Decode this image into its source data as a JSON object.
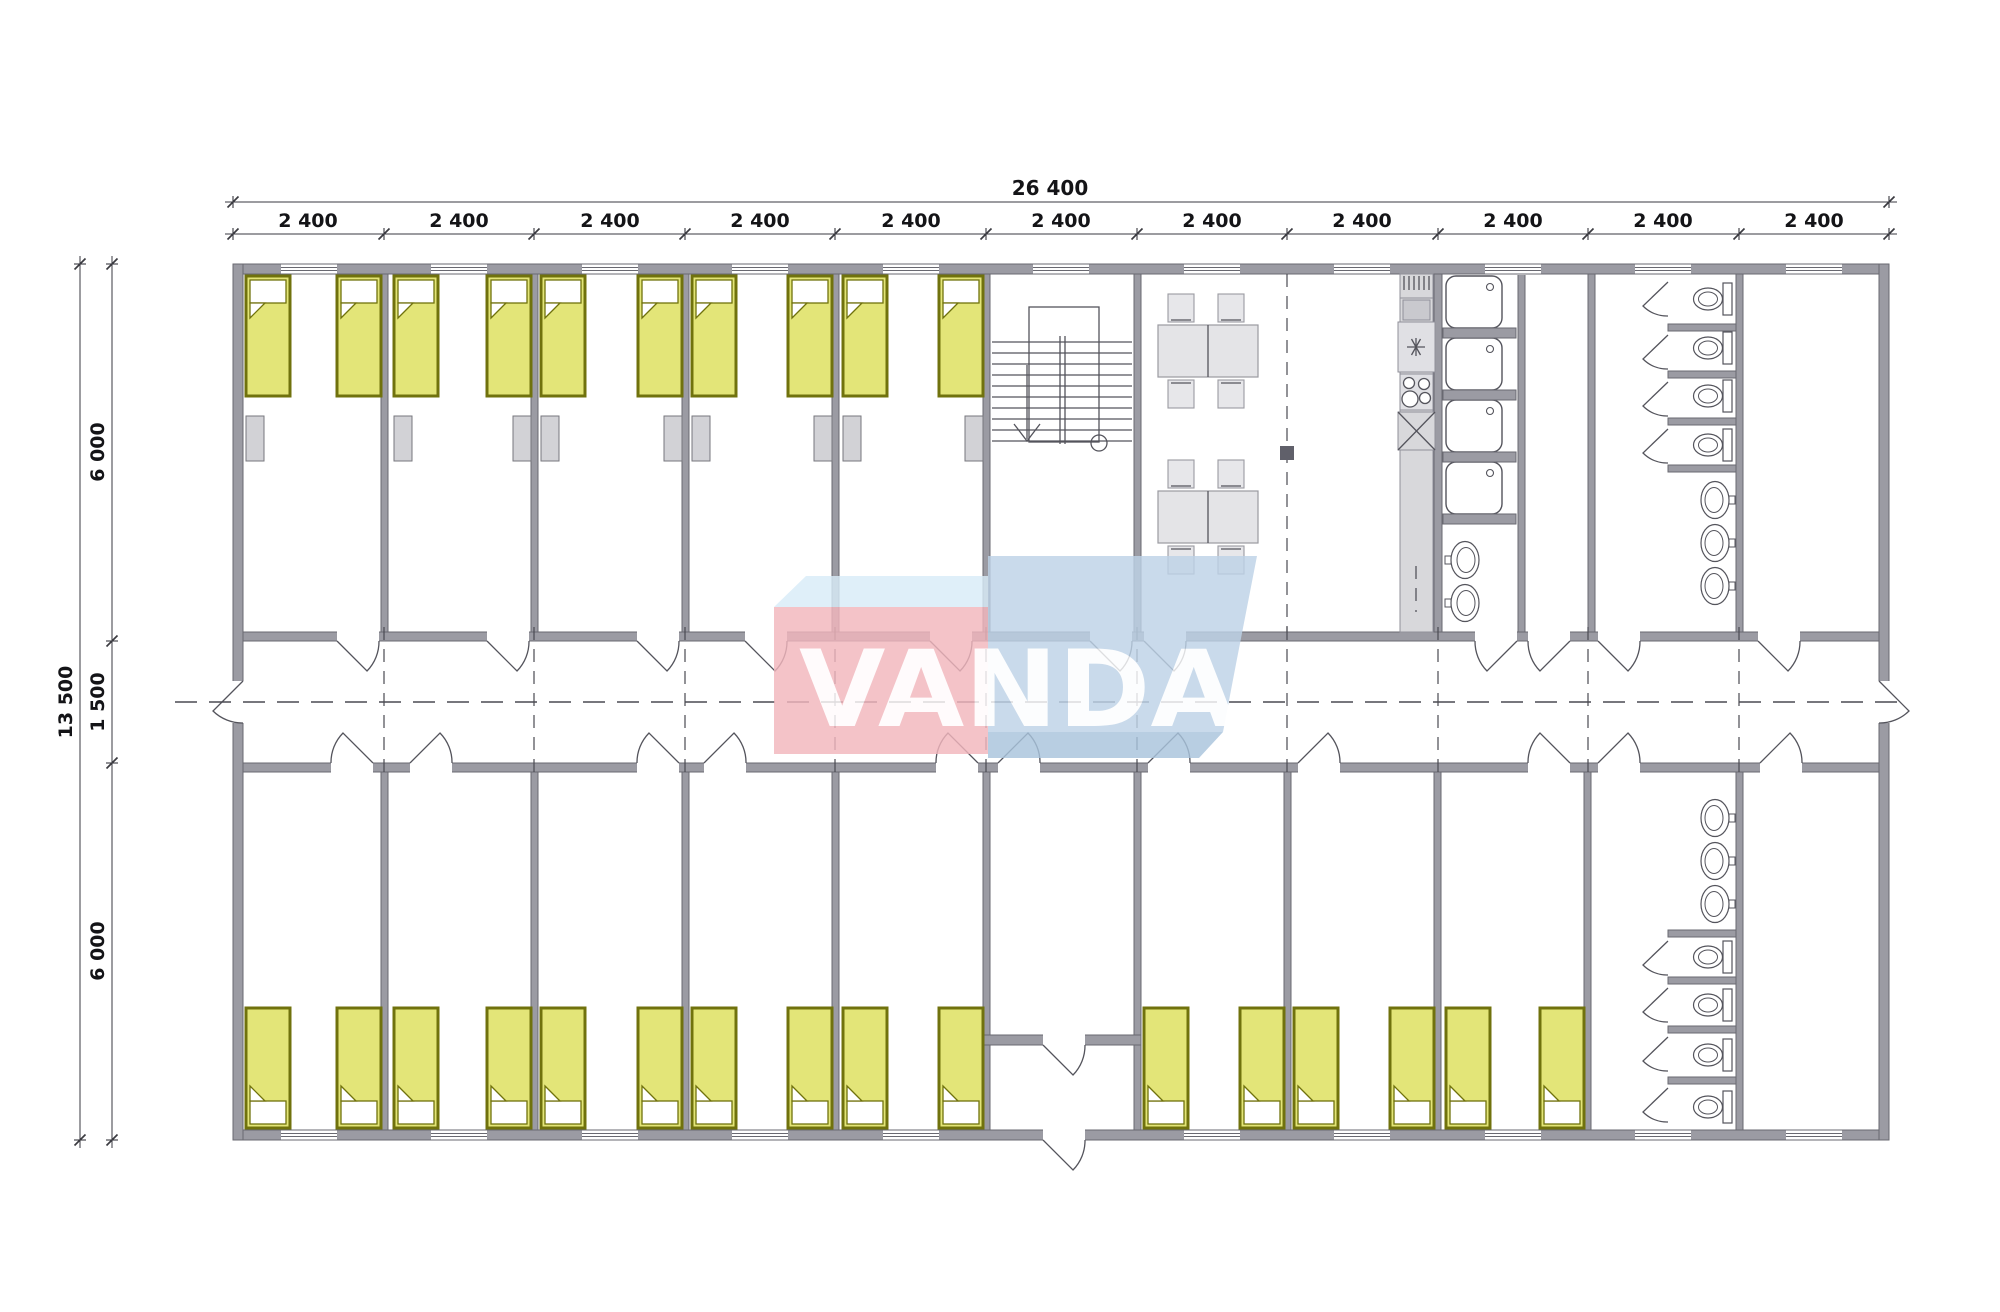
{
  "watermark": {
    "text": "VANDA",
    "pink": "#f2b6bd",
    "blue": "#bed3e7",
    "light_blue": "#d8ecf8",
    "shadow_blue": "#a9c4dc"
  },
  "dimensions": {
    "total_width": "26 400",
    "bay": "2 400",
    "bay_count": 11,
    "total_height": "13 500",
    "top_section": "6 000",
    "corridor": "1 500",
    "bottom_section": "6 000"
  },
  "colors": {
    "wall": "#9b9ba3",
    "bed_fill": "#e3e578",
    "bed_border": "#70720d",
    "furniture_gray": "#d8d8db",
    "line": "#54545c",
    "background": "#ffffff"
  }
}
